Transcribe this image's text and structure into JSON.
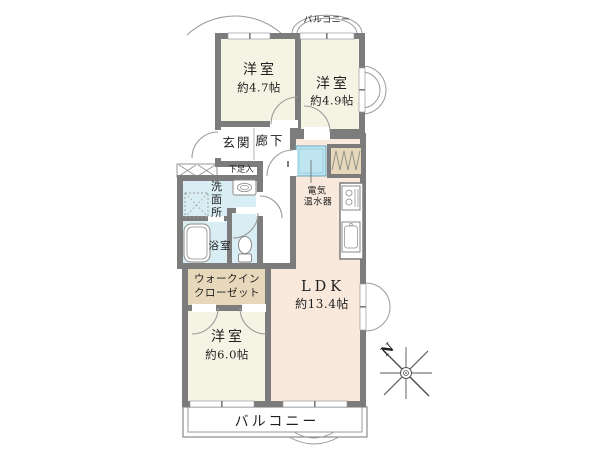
{
  "floor_plan": {
    "rooms": {
      "bedroom_top_left": {
        "name": "洋室",
        "area": "約4.7帖"
      },
      "bedroom_top_right": {
        "name": "洋室",
        "area": "約4.9帖"
      },
      "bedroom_bottom": {
        "name": "洋室",
        "area": "約6.0帖"
      },
      "ldk": {
        "name": "LDK",
        "area": "約13.4帖"
      },
      "entrance": {
        "label": "玄関"
      },
      "corridor": {
        "label": "廊下"
      },
      "shoe_cabinet": {
        "label": "下足入"
      },
      "washroom": {
        "label": "洗面所"
      },
      "bathroom": {
        "label": "浴室"
      },
      "water_heater": {
        "label_line1": "電気",
        "label_line2": "温水器"
      },
      "walk_in_closet": {
        "label_line1": "ウォークイン",
        "label_line2": "クローゼット"
      },
      "balcony_top": {
        "label": "バルコニー"
      },
      "balcony_bottom": {
        "label": "バルコニー"
      }
    },
    "compass": {
      "north_label": "N"
    },
    "colors": {
      "wall": "#7c7c7c",
      "bedroom_fill": "#f5f4e4",
      "ldk_fill": "#f9e8dc",
      "wet_area_fill": "#d9edf4",
      "closet_fill": "#e8d8bb",
      "water_heater_fill": "#bfe5f0",
      "outline": "#9a9a9a"
    }
  }
}
